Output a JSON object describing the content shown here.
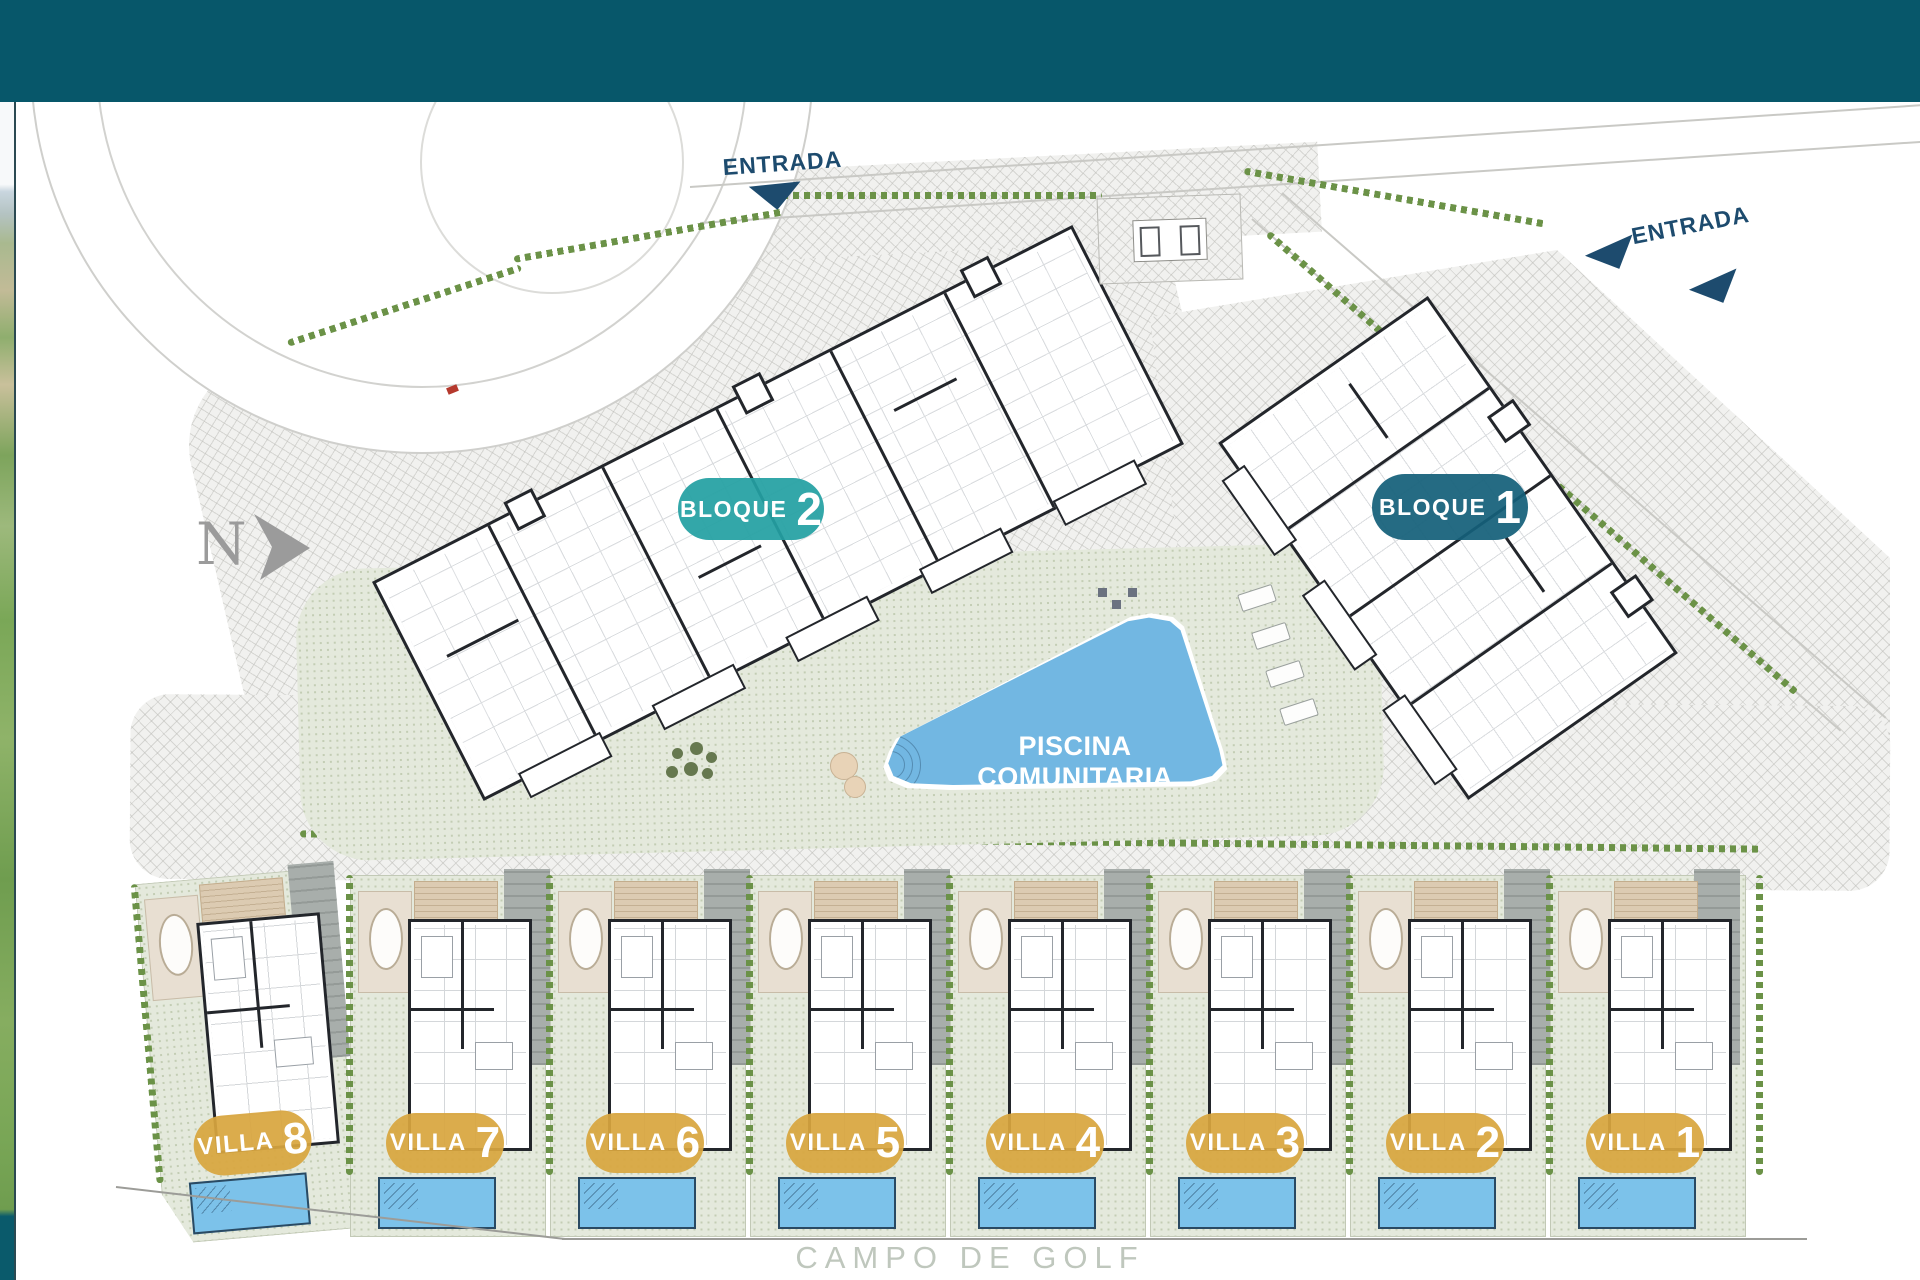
{
  "site": {
    "entrances": [
      {
        "label": "ENTRADA"
      },
      {
        "label": "ENTRADA"
      }
    ],
    "blocks": [
      {
        "label": "BLOQUE",
        "number": "2",
        "color": "#24a0a3"
      },
      {
        "label": "BLOQUE",
        "number": "1",
        "color": "#14607a"
      }
    ],
    "pool": {
      "label": "PISCINA COMUNITARIA",
      "color": "#72b7e2"
    },
    "villas": [
      {
        "label": "VILLA",
        "number": "8"
      },
      {
        "label": "VILLA",
        "number": "7"
      },
      {
        "label": "VILLA",
        "number": "6"
      },
      {
        "label": "VILLA",
        "number": "5"
      },
      {
        "label": "VILLA",
        "number": "4"
      },
      {
        "label": "VILLA",
        "number": "3"
      },
      {
        "label": "VILLA",
        "number": "2"
      },
      {
        "label": "VILLA",
        "number": "1"
      }
    ],
    "villa_pill_color": "#d8a63e",
    "golf": {
      "label": "CAMPO DE GOLF"
    },
    "north": {
      "label": "N"
    },
    "colors": {
      "header_bar": "#07576a",
      "entrance_navy": "#1d4b6e",
      "villa_pool_blue": "#7cc2ea",
      "garden_sage": "#e4e9dc",
      "hedge_green": "#6b9247"
    }
  }
}
